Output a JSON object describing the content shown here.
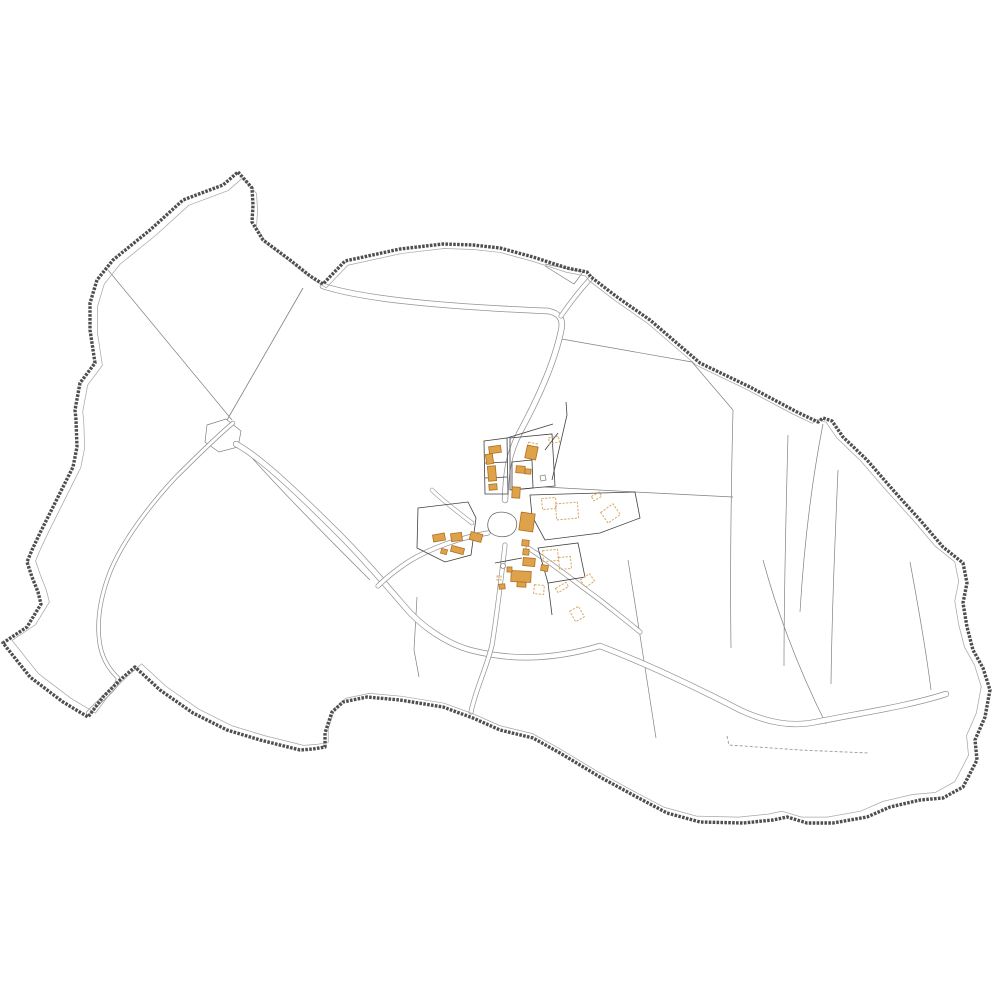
{
  "map": {
    "kind": "cadastral-commune-map",
    "background": "#ffffff",
    "colors": {
      "boundary": "#4f4f4f",
      "offset": "#a8a8a8",
      "parcel": "#808080",
      "parcelDark": "#404040",
      "road": "#929292",
      "roadFill": "#ffffff",
      "stream": "#8d8d8d",
      "pond": "#6a6a6a",
      "well": "#8a8a8a",
      "footpath": "#9a9a9a",
      "buildingFill": "#dea34a",
      "buildingStroke": "#b06f22",
      "buildingDashed": "#d7a868"
    },
    "boundary": {
      "d": "M238,172 L252,188 L253,205 L252,222 L263,240 L290,260 L310,276 L323,284 L345,261 L400,249 L443,244 L473,245 L500,248 L533,257 L567,268 L587,272 L591,277 L617,297 L650,320 L700,363 L750,387 L797,412 L818,422 L823,418 L832,421 L843,437 L867,460 L893,490 L920,520 L943,547 L963,563 L967,583 L963,603 L967,627 L973,650 L983,668 L990,690 L985,717 L975,740 L977,760 L963,787 L943,798 L920,800 L890,807 L867,817 L833,823 L807,823 L787,817 L773,820 L743,823 L700,822 L667,813 L633,795 L600,777 L560,753 L533,738 L500,730 L473,718 L443,707 L400,700 L367,697 L343,702 L332,712 L325,733 L325,747 L313,749 L300,750 L260,740 L227,730 L193,713 L160,690 L135,667 L120,680 L103,697 L88,717 L63,702 L30,677 L3,643 L27,627 L41,604 L38,592 L32,577 L27,562 L32,550 L40,533 L53,507 L65,483 L73,467 L77,447 L76,420 L75,410 L80,383 L95,363 L90,330 L90,303 L97,280 L113,260 L150,230 L183,200 L223,185 Z",
      "width": 3.4,
      "dash": "2.6 1.3",
      "offsetScale": 0.982,
      "offsetCenter": [
        505,
        495
      ],
      "offsetWidth": 0.75
    },
    "features": [
      {
        "name": "parcel-line-nw-diagonal",
        "kind": "line",
        "d": "M108,270 L232,420",
        "stroke": "parcel",
        "width": 0.7
      },
      {
        "name": "parcel-line-steep-diagonal",
        "kind": "line",
        "d": "M303,288 L223,427",
        "stroke": "parcel",
        "width": 0.8
      },
      {
        "name": "parcel-wedge-top",
        "kind": "line",
        "d": "M545,264 L583,272 L574,284 L545,266",
        "stroke": "parcel",
        "width": 0.7
      },
      {
        "name": "parcel-line-ne-field",
        "kind": "line",
        "d": "M556,338 L692,362 L733,410",
        "stroke": "parcel",
        "width": 0.7
      },
      {
        "name": "parcel-line-village-ne-edge",
        "kind": "line",
        "d": "M566,402 L567,415 L552,480",
        "stroke": "parcelDark",
        "width": 0.8
      },
      {
        "name": "parcel-line-village-ne-corner",
        "kind": "line",
        "d": "M558,433 L545,450",
        "stroke": "parcelDark",
        "width": 0.8
      },
      {
        "name": "parcel-line-east-west",
        "kind": "line",
        "d": "M545,487 L635,492 L733,497",
        "stroke": "parcel",
        "width": 0.7
      },
      {
        "name": "parcel-strip-1",
        "kind": "line",
        "d": "M733,410 C731,490 730,570 731,648",
        "stroke": "parcel",
        "width": 0.7
      },
      {
        "name": "parcel-strip-2",
        "kind": "line",
        "d": "M788,435 C786,510 784,590 784,666",
        "stroke": "parcel",
        "width": 0.7
      },
      {
        "name": "parcel-strip-3",
        "kind": "line",
        "d": "M838,470 C835,540 832,610 831,684",
        "stroke": "parcel",
        "width": 0.7
      },
      {
        "name": "parcel-line-notch-south",
        "kind": "line",
        "d": "M823,424 C812,480 804,545 800,612",
        "stroke": "parcel",
        "width": 0.7
      },
      {
        "name": "parcel-line-se-diagonal",
        "kind": "line",
        "d": "M763,560 C778,615 800,672 826,724",
        "stroke": "parcel",
        "width": 0.7
      },
      {
        "name": "parcel-line-far-right",
        "kind": "line",
        "d": "M910,562 C918,605 926,650 931,690",
        "stroke": "parcel",
        "width": 0.7
      },
      {
        "name": "parcel-line-south-center",
        "kind": "line",
        "d": "M628,560 C638,620 648,690 656,738",
        "stroke": "parcel",
        "width": 0.7
      },
      {
        "name": "parcel-line-southwest-1",
        "kind": "line",
        "d": "M417,597 L414,650 L419,677",
        "stroke": "parcel",
        "width": 0.7
      },
      {
        "name": "parcel-line-southwest-2",
        "kind": "line",
        "d": "M245,450 C280,490 330,540 370,580",
        "stroke": "parcel",
        "width": 0.7
      },
      {
        "name": "footpath-dashed",
        "kind": "line",
        "d": "M727,736 L729,745 L800,750 L868,753",
        "stroke": "footpath",
        "width": 0.9,
        "dash": "3 2"
      },
      {
        "name": "stream-pocket-parcel",
        "kind": "area",
        "d": "M207,425 L226,419 L241,431 L238,447 L219,452 L205,442 Z",
        "stroke": "parcel",
        "width": 0.7,
        "fill": "#ffffff"
      },
      {
        "name": "stream",
        "kind": "double",
        "d": "M233,423 C215,438 193,460 175,478 C150,505 123,540 110,572 C100,598 96,622 100,645 C103,662 112,672 118,678 C118,688 104,696 88,713",
        "stroke": "stream",
        "width": 4.4,
        "innerWidth": 3.0
      },
      {
        "name": "main-road",
        "kind": "double",
        "d": "M323,286 C360,298 430,306 548,311 C559,313 564,319 561,331 C555,360 540,395 520,432 C508,455 506,473 505,500",
        "stroke": "road",
        "width": 6.4,
        "innerWidth": 4.9
      },
      {
        "name": "road-boundary-spur",
        "kind": "double",
        "d": "M561,316 C570,303 580,290 591,278",
        "stroke": "road",
        "width": 5,
        "innerWidth": 3.6
      },
      {
        "name": "southwest-road",
        "kind": "double",
        "d": "M236,444 C262,458 305,500 340,535 C365,560 392,592 405,607 C420,625 445,643 470,650 C505,659 545,662 600,646 C650,665 705,692 740,710 C768,723 792,727 816,722 C860,713 905,707 946,694",
        "stroke": "road",
        "width": 6.2,
        "innerWidth": 4.8
      },
      {
        "name": "village-south-road",
        "kind": "double",
        "d": "M505,545 C501,580 497,615 492,645 C486,670 476,688 471,712",
        "stroke": "road",
        "width": 5,
        "innerWidth": 3.6
      },
      {
        "name": "village-east-road",
        "kind": "double",
        "d": "M528,548 C548,560 575,582 600,600 C615,612 628,622 640,632",
        "stroke": "road",
        "width": 5,
        "innerWidth": 3.6
      },
      {
        "name": "village-west-road",
        "kind": "double",
        "d": "M488,533 C462,537 430,548 408,562 C396,570 386,578 378,586",
        "stroke": "road",
        "width": 5,
        "innerWidth": 3.6
      },
      {
        "name": "farm-track",
        "kind": "double",
        "d": "M432,490 C440,498 455,510 472,523",
        "stroke": "road",
        "width": 4.4,
        "innerWidth": 3.2
      },
      {
        "name": "village-parcel-north-left",
        "kind": "area",
        "d": "M484,441 L507,438 L508,494 L485,494 Z",
        "stroke": "parcelDark",
        "width": 0.8,
        "fill": "none"
      },
      {
        "name": "village-parcel-divider-1",
        "kind": "line",
        "d": "M485,463 L507,462",
        "stroke": "parcelDark",
        "width": 0.8
      },
      {
        "name": "village-parcel-divider-2",
        "kind": "line",
        "d": "M485,478 L507,477",
        "stroke": "parcelDark",
        "width": 0.8
      },
      {
        "name": "village-parcel-north-top",
        "kind": "line",
        "d": "M507,438 L553,424",
        "stroke": "parcelDark",
        "width": 0.8
      },
      {
        "name": "village-parcel-north-right",
        "kind": "area",
        "d": "M510,438 L552,434 L555,486 L510,490 Z",
        "stroke": "parcelDark",
        "width": 0.8,
        "fill": "none"
      },
      {
        "name": "village-parcel-inner-box",
        "kind": "area",
        "d": "M512,462 L532,460 L533,488 L512,490 Z",
        "stroke": "parcelDark",
        "width": 0.8,
        "fill": "none"
      },
      {
        "name": "village-parcel-east",
        "kind": "area",
        "d": "M530,495 L532,516 L545,540 L600,533 L640,518 L635,492 Z",
        "stroke": "parcelDark",
        "width": 0.8,
        "fill": "none"
      },
      {
        "name": "village-parcel-south-box",
        "kind": "area",
        "d": "M538,548 L578,543 L585,577 L548,583 Z",
        "stroke": "parcelDark",
        "width": 0.8,
        "fill": "none"
      },
      {
        "name": "village-parcel-south-stub",
        "kind": "line",
        "d": "M548,583 L552,615",
        "stroke": "parcelDark",
        "width": 0.8
      },
      {
        "name": "village-parcel-west",
        "kind": "area",
        "d": "M418,508 L468,502 L476,518 L471,555 L445,562 L417,548 Z",
        "stroke": "parcelDark",
        "width": 0.8,
        "fill": "none"
      },
      {
        "name": "village-parcel-south-line",
        "kind": "line",
        "d": "M495,563 L522,558",
        "stroke": "parcelDark",
        "width": 0.8
      },
      {
        "name": "village-pond",
        "kind": "area",
        "d": "M492,515 C487,520 486,528 491,533 C497,538 508,538 513,533 C518,528 518,520 513,516 C507,511 497,511 492,515 Z",
        "stroke": "pond",
        "width": 0.8,
        "fill": "#ffffff"
      },
      {
        "name": "dashed-buildings",
        "kind": "buildings_dashed",
        "items": [
          [
            542,
            498,
            14,
            11,
            -5
          ],
          [
            556,
            503,
            22,
            16,
            -5
          ],
          [
            603,
            507,
            15,
            13,
            -35
          ],
          [
            592,
            494,
            9,
            5,
            -30
          ],
          [
            528,
            443,
            9,
            6,
            10
          ],
          [
            543,
            550,
            15,
            11,
            -5
          ],
          [
            559,
            557,
            12,
            12,
            -5
          ],
          [
            582,
            576,
            11,
            9,
            -35
          ],
          [
            556,
            585,
            12,
            5,
            -30
          ],
          [
            534,
            585,
            10,
            9,
            5
          ],
          [
            549,
            437,
            10,
            6,
            -10
          ],
          [
            572,
            608,
            10,
            12,
            -30
          ],
          [
            497,
            576,
            4,
            4,
            0
          ]
        ]
      },
      {
        "name": "solid-buildings",
        "kind": "buildings_solid",
        "items": [
          [
            489,
            446,
            12,
            7,
            -8
          ],
          [
            486,
            454,
            7,
            10,
            -8
          ],
          [
            488,
            466,
            8,
            15,
            -5
          ],
          [
            489,
            484,
            8,
            6,
            -5
          ],
          [
            526,
            446,
            11,
            13,
            12
          ],
          [
            516,
            466,
            9,
            7,
            5
          ],
          [
            525,
            469,
            6,
            5,
            5
          ],
          [
            512,
            487,
            8,
            11,
            3
          ],
          [
            520,
            513,
            14,
            18,
            8
          ],
          [
            522,
            540,
            7,
            6,
            5
          ],
          [
            523,
            549,
            6,
            6,
            5
          ],
          [
            523,
            558,
            12,
            8,
            5
          ],
          [
            541,
            565,
            7,
            6,
            10
          ],
          [
            511,
            571,
            20,
            11,
            3
          ],
          [
            517,
            582,
            9,
            5,
            3
          ],
          [
            507,
            567,
            5,
            5,
            0
          ],
          [
            499,
            584,
            6,
            5,
            -5
          ],
          [
            433,
            534,
            12,
            7,
            -10
          ],
          [
            451,
            533,
            11,
            8,
            -8
          ],
          [
            470,
            533,
            12,
            8,
            15
          ],
          [
            451,
            547,
            13,
            6,
            15
          ],
          [
            441,
            549,
            6,
            5,
            15
          ]
        ]
      },
      {
        "name": "well-marker-square",
        "kind": "area",
        "d": "M540,476 l5,-1 l1,5 l-5,1 Z",
        "stroke": "well",
        "width": 0.8,
        "fill": "#ffffff"
      },
      {
        "name": "well-marker-circle",
        "kind": "area",
        "d": "M503,563.5 a2.5,2.5 0 1 0 0.01,0 Z",
        "stroke": "well",
        "width": 0.8,
        "fill": "#ffffff"
      }
    ]
  }
}
